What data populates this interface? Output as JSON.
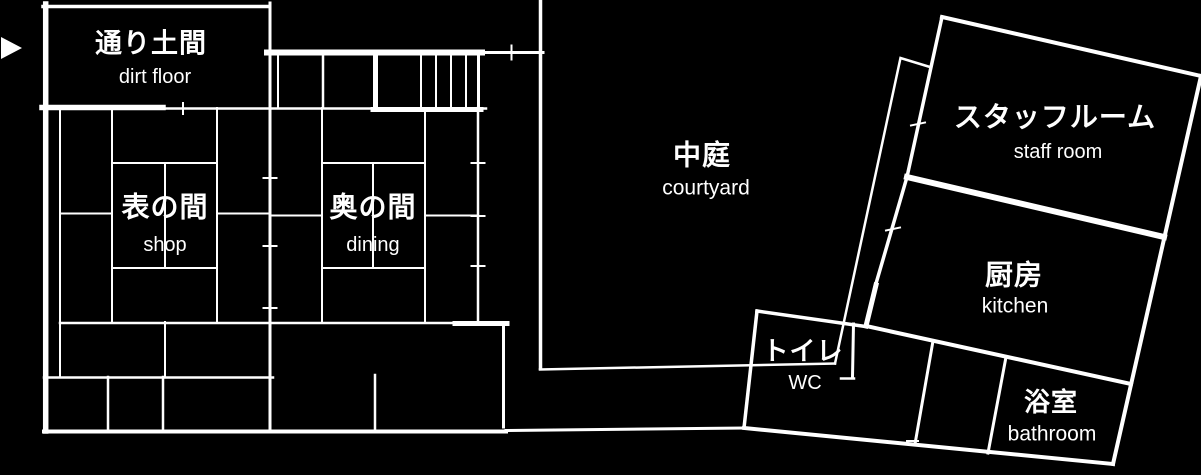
{
  "canvas": {
    "background_color": "#000000",
    "line_color": "#ffffff",
    "text_color": "#ffffff"
  },
  "floor_plan": {
    "type": "architectural-floor-plan",
    "rooms": [
      {
        "id": "dirt_floor",
        "jp": "通り土間",
        "en": "dirt floor"
      },
      {
        "id": "shop",
        "jp": "表の間",
        "en": "shop"
      },
      {
        "id": "dining",
        "jp": "奥の間",
        "en": "dining"
      },
      {
        "id": "courtyard",
        "jp": "中庭",
        "en": "courtyard"
      },
      {
        "id": "staff_room",
        "jp": "スタッフルーム",
        "en": "staff room"
      },
      {
        "id": "kitchen",
        "jp": "厨房",
        "en": "kitchen"
      },
      {
        "id": "wc",
        "jp": "トイレ",
        "en": "WC"
      },
      {
        "id": "bathroom",
        "jp": "浴室",
        "en": "bathroom"
      }
    ],
    "entrance": {
      "icon": "entrance-arrow-icon",
      "direction": "right"
    }
  }
}
